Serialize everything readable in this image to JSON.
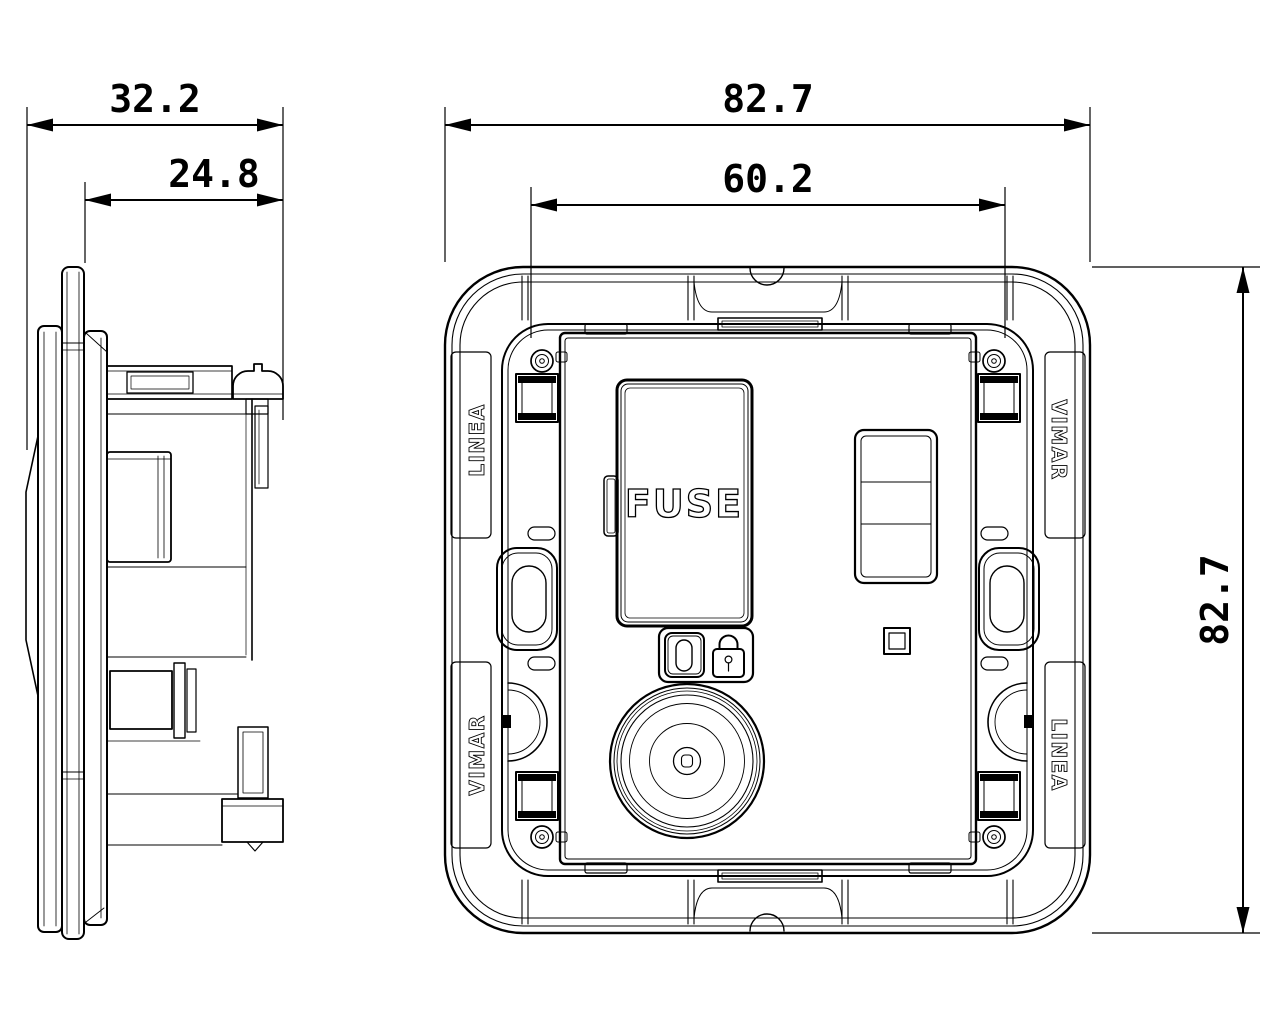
{
  "colors": {
    "ink": "#000000",
    "paper": "#ffffff"
  },
  "dimensions": {
    "side_total_depth": "32.2",
    "side_flush_depth": "24.8",
    "front_width": "82.7",
    "front_inner_width": "60.2",
    "front_height": "82.7"
  },
  "labels": {
    "fuse_door": "FUSE",
    "frame_top_left": "LINEA",
    "frame_top_right": "VIMAR",
    "frame_bottom_left": "VIMAR",
    "frame_bottom_right": "LINEA"
  }
}
